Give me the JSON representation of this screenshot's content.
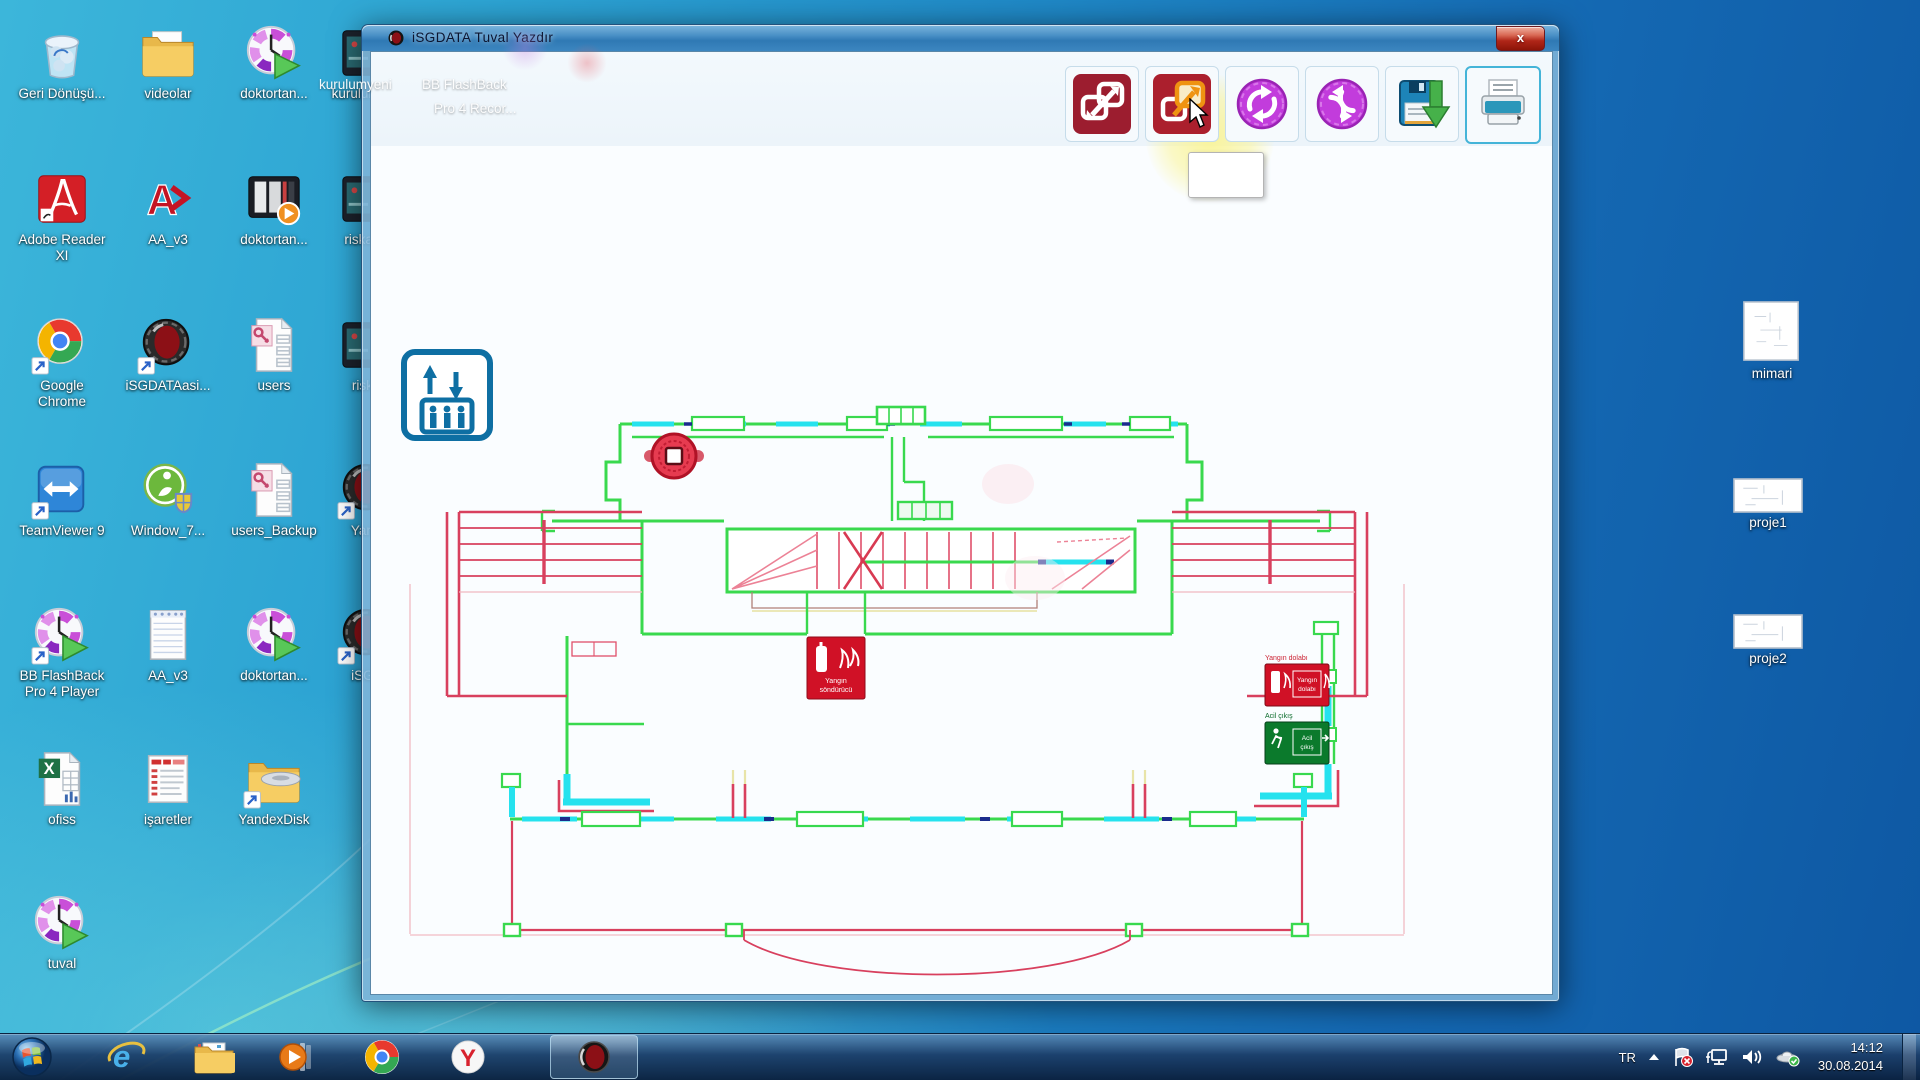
{
  "window": {
    "title": "iSGDATA Tuval  Yazdır",
    "close_glyph": "x",
    "toolbar_buttons": [
      {
        "name": "transfer-red-icon"
      },
      {
        "name": "resize-orange-icon",
        "state": "hover"
      },
      {
        "name": "rotate-magenta-icon"
      },
      {
        "name": "rotate-magenta-2-icon"
      },
      {
        "name": "save-icon"
      },
      {
        "name": "print-icon",
        "state": "selected"
      }
    ]
  },
  "ghost": {
    "label1": "kurulumyeni",
    "label2": "BB FlashBack",
    "label3": "Pro 4 Recor..."
  },
  "plan": {
    "extinguisher_sign": {
      "line1": "Yangın",
      "line2": "söndürücü"
    },
    "cabinet_sign": {
      "label": "Yangın dolabı",
      "line1": "Yangın",
      "line2": "dolabı"
    },
    "exit_sign": {
      "label": "Acil çıkış",
      "line1": "Acil",
      "line2": "çıkış"
    }
  },
  "desktop": {
    "left_icons": [
      {
        "label": "Geri Dönüşü...",
        "type": "recycle",
        "col": 0,
        "row": 0,
        "shortcut": false
      },
      {
        "label": "videolar",
        "type": "folder",
        "col": 1,
        "row": 0,
        "shortcut": false
      },
      {
        "label": "doktortan...",
        "type": "clockplay",
        "col": 2,
        "row": 0,
        "shortcut": false
      },
      {
        "label": "kurulumyeni",
        "type": "appbox",
        "col": 3,
        "row": 0,
        "shortcut": false
      },
      {
        "label": "Adobe Reader XI",
        "type": "adobe",
        "col": 0,
        "row": 1,
        "shortcut": false
      },
      {
        "label": "AA_v3",
        "type": "aa",
        "col": 1,
        "row": 1,
        "shortcut": false
      },
      {
        "label": "doktortan...",
        "type": "media",
        "col": 2,
        "row": 1,
        "shortcut": false
      },
      {
        "label": "riskan...",
        "type": "appbox",
        "col": 3,
        "row": 1,
        "shortcut": false
      },
      {
        "label": "Google Chrome",
        "type": "chrome",
        "col": 0,
        "row": 2,
        "shortcut": true
      },
      {
        "label": "iSGDATAasi...",
        "type": "sphere",
        "col": 1,
        "row": 2,
        "shortcut": true
      },
      {
        "label": "users",
        "type": "accessfile",
        "col": 2,
        "row": 2,
        "shortcut": false
      },
      {
        "label": "risk...",
        "type": "appbox",
        "col": 3,
        "row": 2,
        "shortcut": false
      },
      {
        "label": "TeamViewer 9",
        "type": "teamviewer",
        "col": 0,
        "row": 3,
        "shortcut": true
      },
      {
        "label": "Window_7...",
        "type": "win7",
        "col": 1,
        "row": 3,
        "shortcut": false
      },
      {
        "label": "users_Backup",
        "type": "accessfile",
        "col": 2,
        "row": 3,
        "shortcut": false
      },
      {
        "label": "Yan...",
        "type": "sphere",
        "col": 3,
        "row": 3,
        "shortcut": true
      },
      {
        "label": "BB FlashBack Pro 4 Player",
        "type": "clockplay",
        "col": 0,
        "row": 4,
        "shortcut": true
      },
      {
        "label": "AA_v3",
        "type": "notepad",
        "col": 1,
        "row": 4,
        "shortcut": false
      },
      {
        "label": "doktortan...",
        "type": "clockplay",
        "col": 2,
        "row": 4,
        "shortcut": false
      },
      {
        "label": "iSG...",
        "type": "sphere",
        "col": 3,
        "row": 4,
        "shortcut": true
      },
      {
        "label": "ofiss",
        "type": "excel",
        "col": 0,
        "row": 5,
        "shortcut": false
      },
      {
        "label": "işaretler",
        "type": "doc",
        "col": 1,
        "row": 5,
        "shortcut": false
      },
      {
        "label": "YandexDisk",
        "type": "yandexfolder",
        "col": 2,
        "row": 5,
        "shortcut": true
      },
      {
        "label": "tuval",
        "type": "clockplay",
        "col": 0,
        "row": 6,
        "shortcut": false
      }
    ],
    "right_icons": [
      {
        "label": "mimari",
        "type": "thumb_square",
        "x": 1726,
        "y": 300
      },
      {
        "label": "proje1",
        "type": "thumb_wide",
        "x": 1722,
        "y": 478
      },
      {
        "label": "proje2",
        "type": "thumb_wide",
        "x": 1722,
        "y": 614
      }
    ]
  },
  "taskbar": {
    "buttons": [
      "start",
      "internet-explorer",
      "windows-explorer",
      "media-player",
      "chrome",
      "yandex-browser",
      "isgdata-active"
    ],
    "tray": {
      "language": "TR",
      "time": "14:12",
      "date": "30.08.2014"
    }
  }
}
